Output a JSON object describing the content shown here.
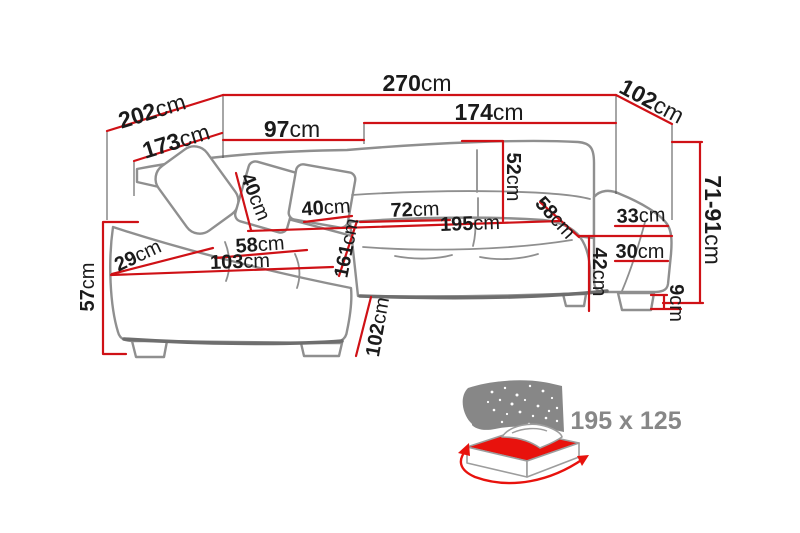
{
  "colors": {
    "dimension_red": "#cf1116",
    "outline_gray": "#8f8f8f",
    "outline_dark": "#6e6e6e",
    "text_black": "#1b1b1b",
    "icon_gray": "#878787",
    "bed_red": "#e8120d"
  },
  "labels": {
    "total_width": {
      "value": "270",
      "unit": "cm"
    },
    "back_left_depth": {
      "value": "202",
      "unit": "cm"
    },
    "inner_left_depth": {
      "value": "173",
      "unit": "cm"
    },
    "back_right_width": {
      "value": "102",
      "unit": "cm"
    },
    "corner_back_width": {
      "value": "97",
      "unit": "cm"
    },
    "front_section_width": {
      "value": "174",
      "unit": "cm"
    },
    "height_range": {
      "value": "71-91",
      "unit": "cm"
    },
    "backrest_height": {
      "value": "52",
      "unit": "cm"
    },
    "pillow_left": {
      "value": "40",
      "unit": "cm"
    },
    "pillow_right": {
      "value": "40",
      "unit": "cm"
    },
    "seat_section_width": {
      "value": "72",
      "unit": "cm"
    },
    "sleeping_length": {
      "value": "195",
      "unit": "cm"
    },
    "seat_depth": {
      "value": "58",
      "unit": "cm"
    },
    "armrest_top_width": {
      "value": "33",
      "unit": "cm"
    },
    "armrest_base_width": {
      "value": "30",
      "unit": "cm"
    },
    "seat_front_height": {
      "value": "42",
      "unit": "cm"
    },
    "leg_height": {
      "value": "9",
      "unit": "cm"
    },
    "chaise_cushion_width": {
      "value": "58",
      "unit": "cm"
    },
    "chaise_front_width": {
      "value": "103",
      "unit": "cm"
    },
    "chaise_corner_depth": {
      "value": "29",
      "unit": "cm"
    },
    "seat_height": {
      "value": "57",
      "unit": "cm"
    },
    "chaise_length": {
      "value": "161",
      "unit": "cm"
    },
    "chaise_depth": {
      "value": "102",
      "unit": "cm"
    }
  },
  "sleeping_area": {
    "size_label": "195 x 125"
  }
}
